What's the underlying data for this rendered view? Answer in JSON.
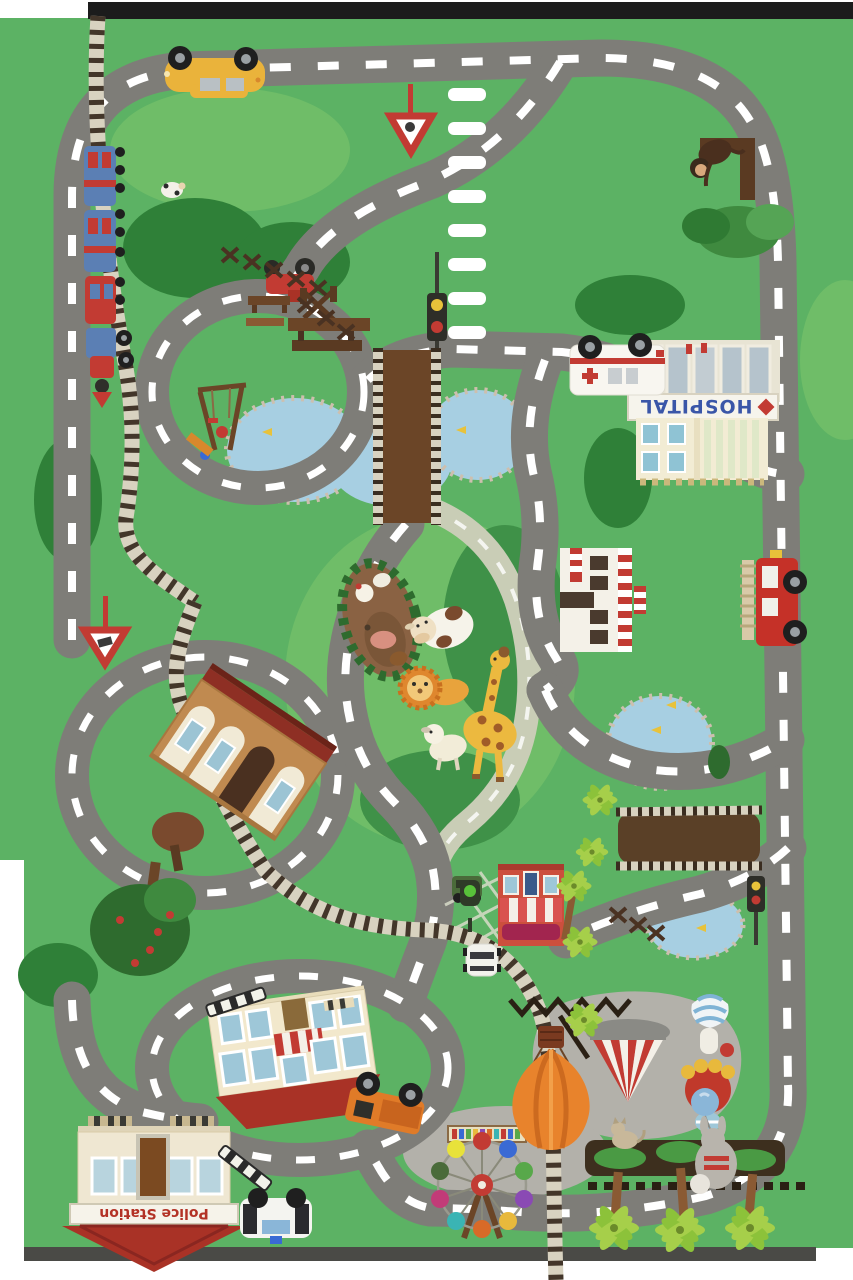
{
  "mat": {
    "title": "Kids city road play mat",
    "signs": {
      "hospital": "HOSPITAL",
      "police_station": "Police Station"
    },
    "colors": {
      "grass": "#5cb264",
      "grass_light": "#6fbd68",
      "grass_dark": "#2f8038",
      "grass_mid_dark": "#3f9148",
      "road": "#7e7d78",
      "road_line": "#ffffff",
      "foot_path": "#c9cdb6",
      "water": "#a7cfe2",
      "pebble": "#cdbfae",
      "bridge_wood": "#6b4527",
      "rail_tie": "#43362a",
      "rail_bed": "#d8d2c0",
      "plaza_gray": "#b3b1aa",
      "roof_red": "#a93226",
      "wall_cream": "#f2e9d2",
      "accent_red": "#c23b33",
      "hospital_text_blue": "#3a56a8",
      "police_text_red": "#b33226",
      "balloon_orange": "#e8832c",
      "palm_green": "#a6cf4a",
      "hedge_dark": "#3d2f1e",
      "frame_dark": "#1c1c1c"
    },
    "landmarks": [
      "hospital",
      "ambulance",
      "police station",
      "police car",
      "school",
      "train station",
      "train",
      "railway",
      "corner shop",
      "striped-awning shop",
      "zoo animals",
      "farm pen",
      "playground",
      "ferris wheel",
      "circus tent",
      "hot air balloon large",
      "hot air balloon small",
      "parachutist",
      "ponds with fish",
      "wooden bridges",
      "zebra crossing",
      "yield signs",
      "traffic lights",
      "fire truck",
      "yellow car",
      "red tractor",
      "orange truck",
      "white car",
      "green jeep",
      "monkey tree",
      "palm trees",
      "cow",
      "lion",
      "giraffe",
      "goat",
      "cat",
      "rabbit with balloon"
    ]
  }
}
